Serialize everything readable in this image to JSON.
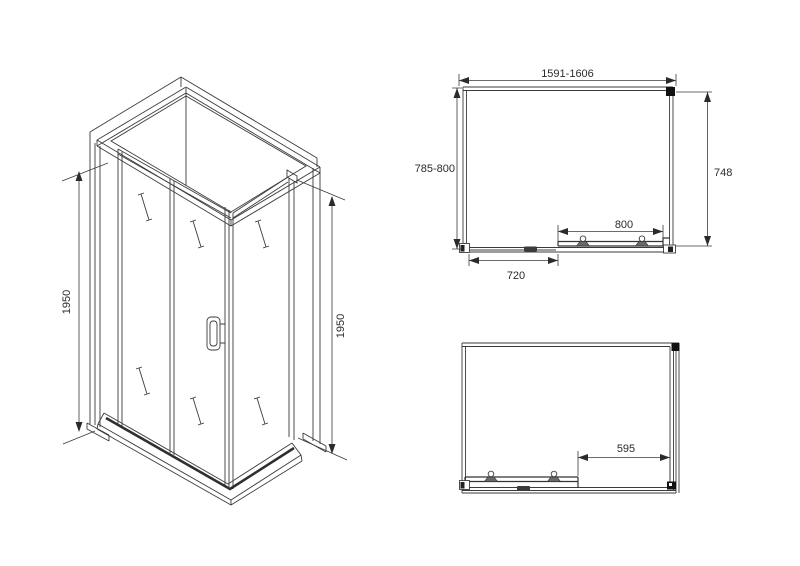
{
  "colors": {
    "background": "#ffffff",
    "line": "#3b3b3b",
    "text": "#2b2b2b",
    "solid_marker": "#111111"
  },
  "views": {
    "isometric": {
      "dim_left_height": "1950",
      "dim_right_height": "1950"
    },
    "plan_top": {
      "dim_width_range": "1591-1606",
      "dim_depth_range": "785-800",
      "dim_side_depth": "748",
      "dim_door_width": "800",
      "dim_fixed_panel": "720"
    },
    "plan_bottom": {
      "dim_opening": "595"
    }
  }
}
